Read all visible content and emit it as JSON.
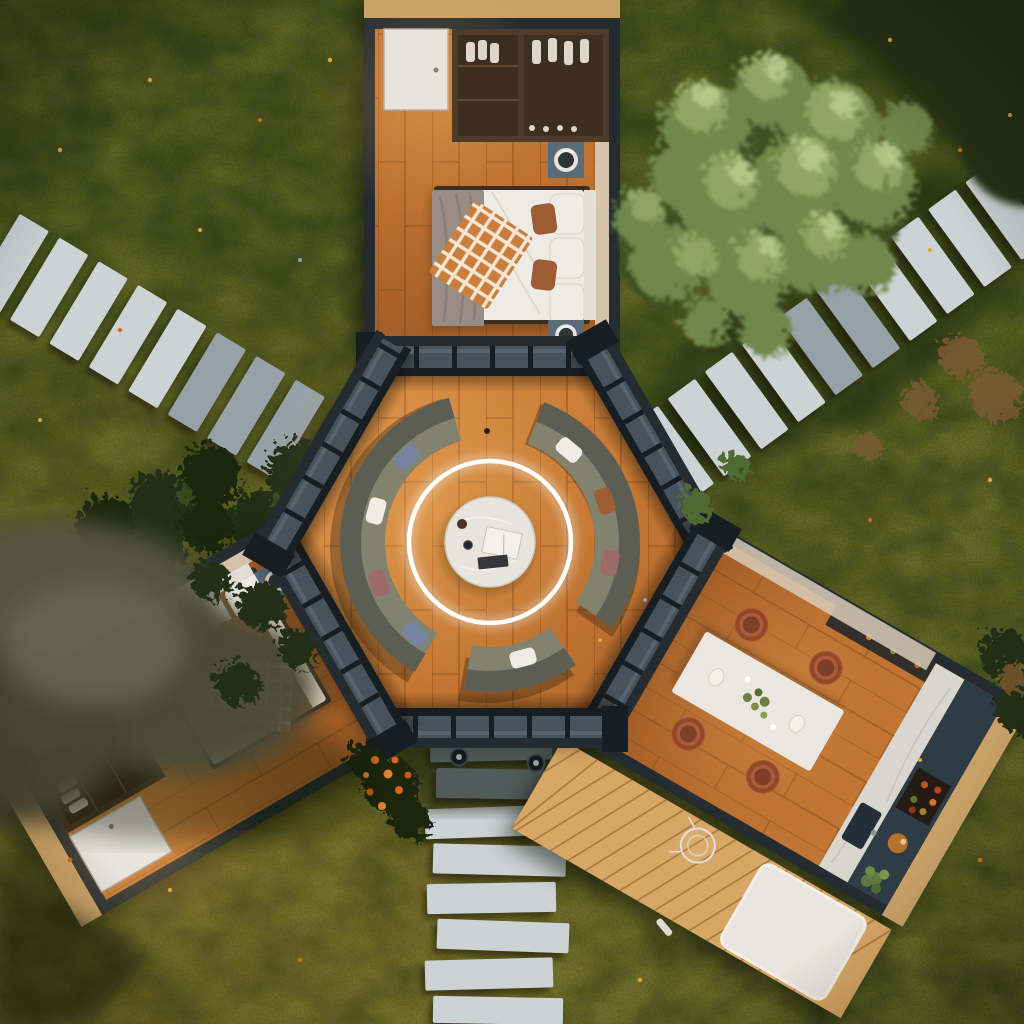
{
  "meta": {
    "description": "Aerial top-down 3D render of a hexagonal glass-walled lounge house with three rectangular wings arranged like a three-pointed star: a bedroom wing at top, a second bedroom wing at lower-left and a dining-kitchen wing at lower-right. The central hexagon holds a circular modular sofa around a round marble coffee table beneath a glowing white LED ring light. Stone paver paths approach from the upper-right, left and bottom; a wooden deck with a white rug sits beside the kitchen wing. The house is surrounded by lawn, a large leafy tree at upper-right, blurred foreground foliage at left, shrubs and scattered wildflowers."
  },
  "colors": {
    "lawnTop": "#46511e",
    "lawnBottom": "#67682a",
    "lawnPatchLight": "#7a7d33",
    "lawnPatchDark": "#2c3913",
    "shadowDeep": "#0f1706",
    "paver": "#cdd2d4",
    "paverShade": "#97a2a8",
    "frame": "#242c31",
    "frameDark": "#171e23",
    "glass": "#46535d",
    "fascia": "#c9a168",
    "woodLight": "#d79049",
    "woodMid": "#bc6f30",
    "woodDark": "#9a5522",
    "woodSeam": "#6b3a14",
    "hexWoodLight": "#d98f47",
    "hexWoodMid": "#c47733",
    "deck": "#d8a765",
    "deckSeam": "#8a5a28",
    "wardrobe": "#4e3b2a",
    "wardrobeDark": "#3c2d1f",
    "clothWhite": "#ddd6c9",
    "door": "#e9e5de",
    "duvet": "#eeebe4",
    "duvetCream": "#e6dcc6",
    "blanketGray": "#988e83",
    "blanketBrown": "#7b5236",
    "plaidBase": "#c97e3e",
    "plaidLine": "#fdf8ef",
    "pillowWhite": "#efece5",
    "pillowRust": "#9d5c33",
    "pillowRose": "#9c6b68",
    "pillowBlue": "#76839f",
    "stand": "#5a6b78",
    "vesselDark": "#2e3438",
    "headboard": "#e4dfd7",
    "sofaBack": "#5d5e53",
    "sofaSeat": "#82836f",
    "ring": "#ffffff",
    "tableMarble": "#e7e4de",
    "diningTable": "#eae7e0",
    "chair": "#ad5c3a",
    "chairDark": "#7e3f28",
    "marble": "#d9d5cf",
    "navy": "#2e3c46",
    "sinkDark": "#232e36",
    "cabinetDark": "#332f28",
    "rug": "#ebe8e2",
    "treeDark": "#3e5022",
    "treeMid": "#71874b",
    "treeLight": "#93a766",
    "treePale": "#bac98d",
    "bushDark": "#222d13",
    "hedge": "#1c260f",
    "canopyBlur": "#565540",
    "canopyBlurLight": "#6b6852",
    "shrubBrown": "#7a5a32",
    "fern": "#4f6a30",
    "tuft": "#96833f",
    "tuftBlue": "#6f86b5",
    "flowerYellow": "#d9a83c",
    "flowerOrange": "#d2691e",
    "flowerBlue": "#8aa0c8",
    "paleStrip": "#d9cdb8"
  },
  "scene": {
    "building": {
      "type": "hexagonal tiny house with three rectangular wings",
      "center_room": "circular lounge with curved modular sofa, round marble coffee table, books, two cups and a circular LED pendant light",
      "wings": [
        {
          "position": "top",
          "room": "bedroom",
          "furniture": "double bed with white duvet, gray throw, orange gingham plaid, rust pillows, two slate nightstands with round vessels, wardrobe with clothes and shoes, white door"
        },
        {
          "position": "lower-left",
          "room": "bedroom",
          "furniture": "double bed with cream duvet, brown blanket, orange gingham plaid, checkered pillows, nightstands with round vessels, wardrobe shelving, white door"
        },
        {
          "position": "lower-right",
          "room": "dining-kitchen",
          "furniture": "white rectangular dining table with plates and greenery, four terracotta chairs, marble counter with steel sink, navy cabinets, shelves with jars, copper bowl, green plant"
        }
      ],
      "glazing": "dark charcoal mullioned glass walls around the hexagon"
    },
    "landscape": {
      "paths": [
        "stone paver path from upper-right",
        "stone paver path from left",
        "staggered stone paver path to bottom"
      ],
      "deck": "light wood plank deck with white shaggy rug and wireframe chair beside kitchen wing",
      "vegetation": [
        "large leafy tree upper-right",
        "dark canopy in top-right corner",
        "blurred foreground canopy at left edge",
        "dark hedges and bushes near left path",
        "orange flowering bush near bottom path",
        "dry brown shrubs and grass tufts",
        "scattered yellow and orange wildflowers"
      ],
      "lights": [
        "two round ground bollard lights at top of bottom path"
      ]
    }
  }
}
